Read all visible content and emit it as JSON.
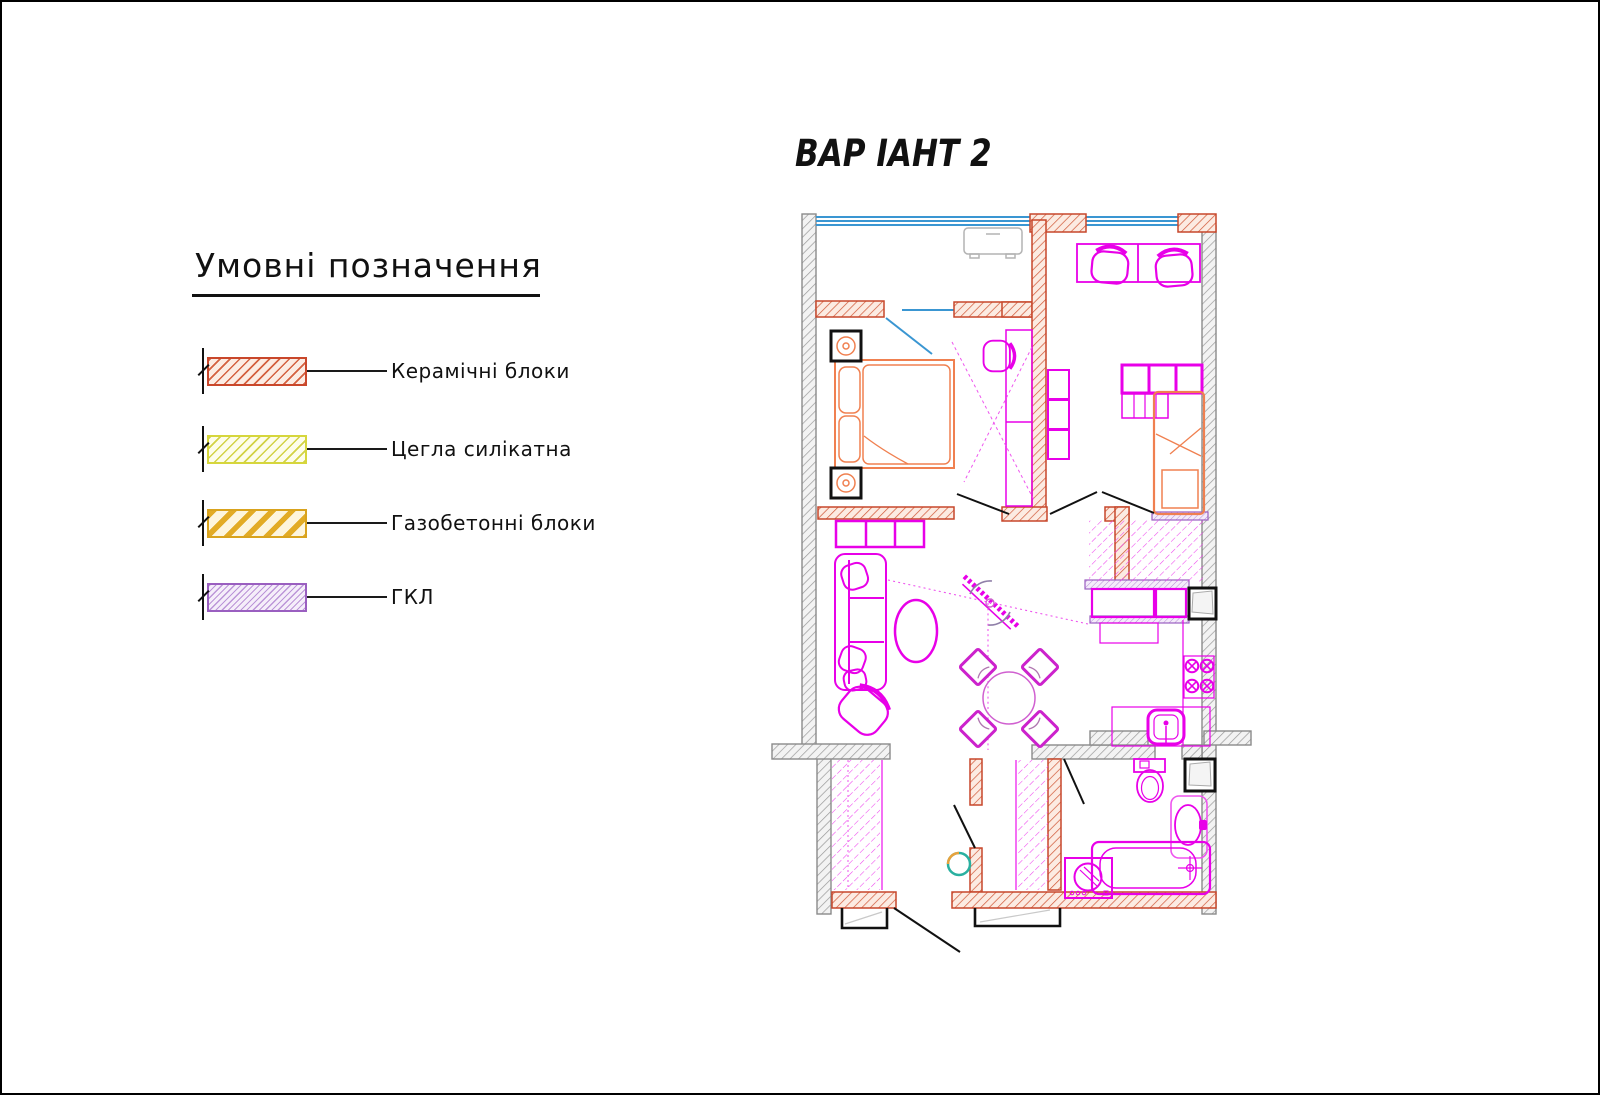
{
  "title": "ВАР ІАНТ 2",
  "legend": {
    "heading": "Умовні позначення",
    "items": [
      {
        "id": "ceramic-blocks",
        "label": "Керамічні блоки",
        "border_color": "#c9472b",
        "hatch_color": "#d4603f",
        "fill_color": "#fbece4"
      },
      {
        "id": "silicate-brick",
        "label": "Цегла силікатна",
        "border_color": "#d6d63c",
        "hatch_color": "#d2d245",
        "fill_color": "#fdfdea"
      },
      {
        "id": "aerated-concrete-blocks",
        "label": "Газобетонні блоки",
        "border_color": "#d9a31d",
        "hatch_color": "#e2ab25",
        "fill_color": "#fdf5dd"
      },
      {
        "id": "gkl-plasterboard",
        "label": "ГКЛ",
        "border_color": "#9a5fc0",
        "hatch_color": "#bb95d8",
        "fill_color": "#f5eefa"
      }
    ]
  },
  "plan": {
    "colors": {
      "window_glazing": "#3a96d2",
      "exterior_wall_hatch": "#999999",
      "ceramic_wall_hatch": "#cf5534",
      "gkl_wall_hatch": "#b48cd4",
      "furniture_magenta": "#e800e8",
      "furniture_orange": "#f08050",
      "door_lines": "#111111",
      "boiler_teal": "#29b0a0"
    }
  }
}
